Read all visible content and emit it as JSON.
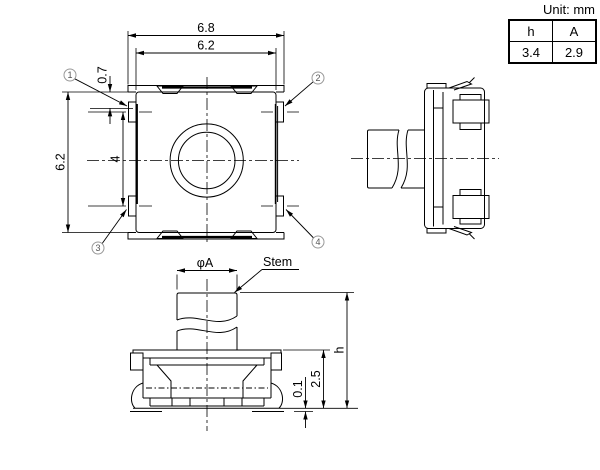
{
  "unit_note": "Unit: mm",
  "spec_table": {
    "headers": [
      "h",
      "A"
    ],
    "values": [
      "3.4",
      "2.9"
    ]
  },
  "top_view": {
    "dim_flange_width": "6.8",
    "dim_body_width": "6.2",
    "dim_body_height": "6.2",
    "dim_terminal_pitch": "4",
    "dim_terminal_width": "0.7",
    "callouts": [
      "1",
      "2",
      "3",
      "4"
    ]
  },
  "front_view": {
    "dim_stem_diameter": "φA",
    "label_stem": "Stem",
    "dim_height_total": "h",
    "dim_body_height": "2.5",
    "dim_standoff": "0.1"
  },
  "colors": {
    "line": "#000000",
    "callout_stroke": "#999999",
    "callout_text": "#555555",
    "background": "#ffffff"
  }
}
